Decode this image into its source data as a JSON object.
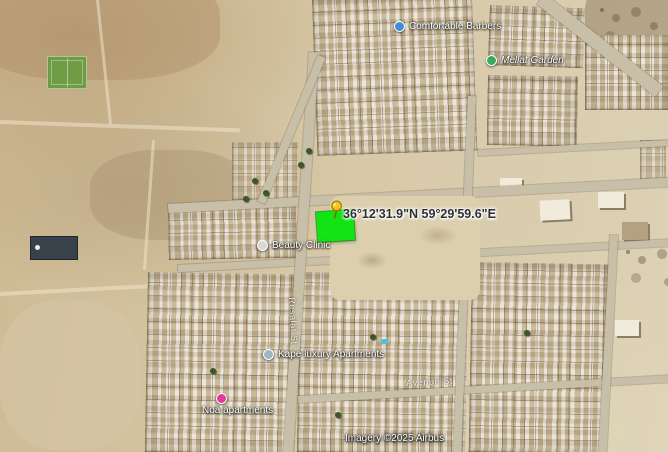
{
  "map": {
    "coordinates_label": "36°12'31.9\"N 59°29'59.6\"E",
    "attribution": "Imagery ©2025 Airbus",
    "plot": {
      "color": "#12e312"
    },
    "pushpin_color": "#f5c51d",
    "pois": [
      {
        "label": "Comfortable Barbers",
        "dot_color": "#3e8ed6"
      },
      {
        "label": "Mellat Garden",
        "dot_color": "#3da75c"
      },
      {
        "label": "Beauty Clinic",
        "dot_color": "#d8d8d8"
      },
      {
        "label": "Kape luxury Apartments",
        "dot_color": "#9fb6c9"
      },
      {
        "label": "Noa apartments",
        "dot_color": "#e6399b"
      }
    ],
    "streets": [
      {
        "label": "Resalat St"
      },
      {
        "label": "Avenue St"
      }
    ]
  }
}
